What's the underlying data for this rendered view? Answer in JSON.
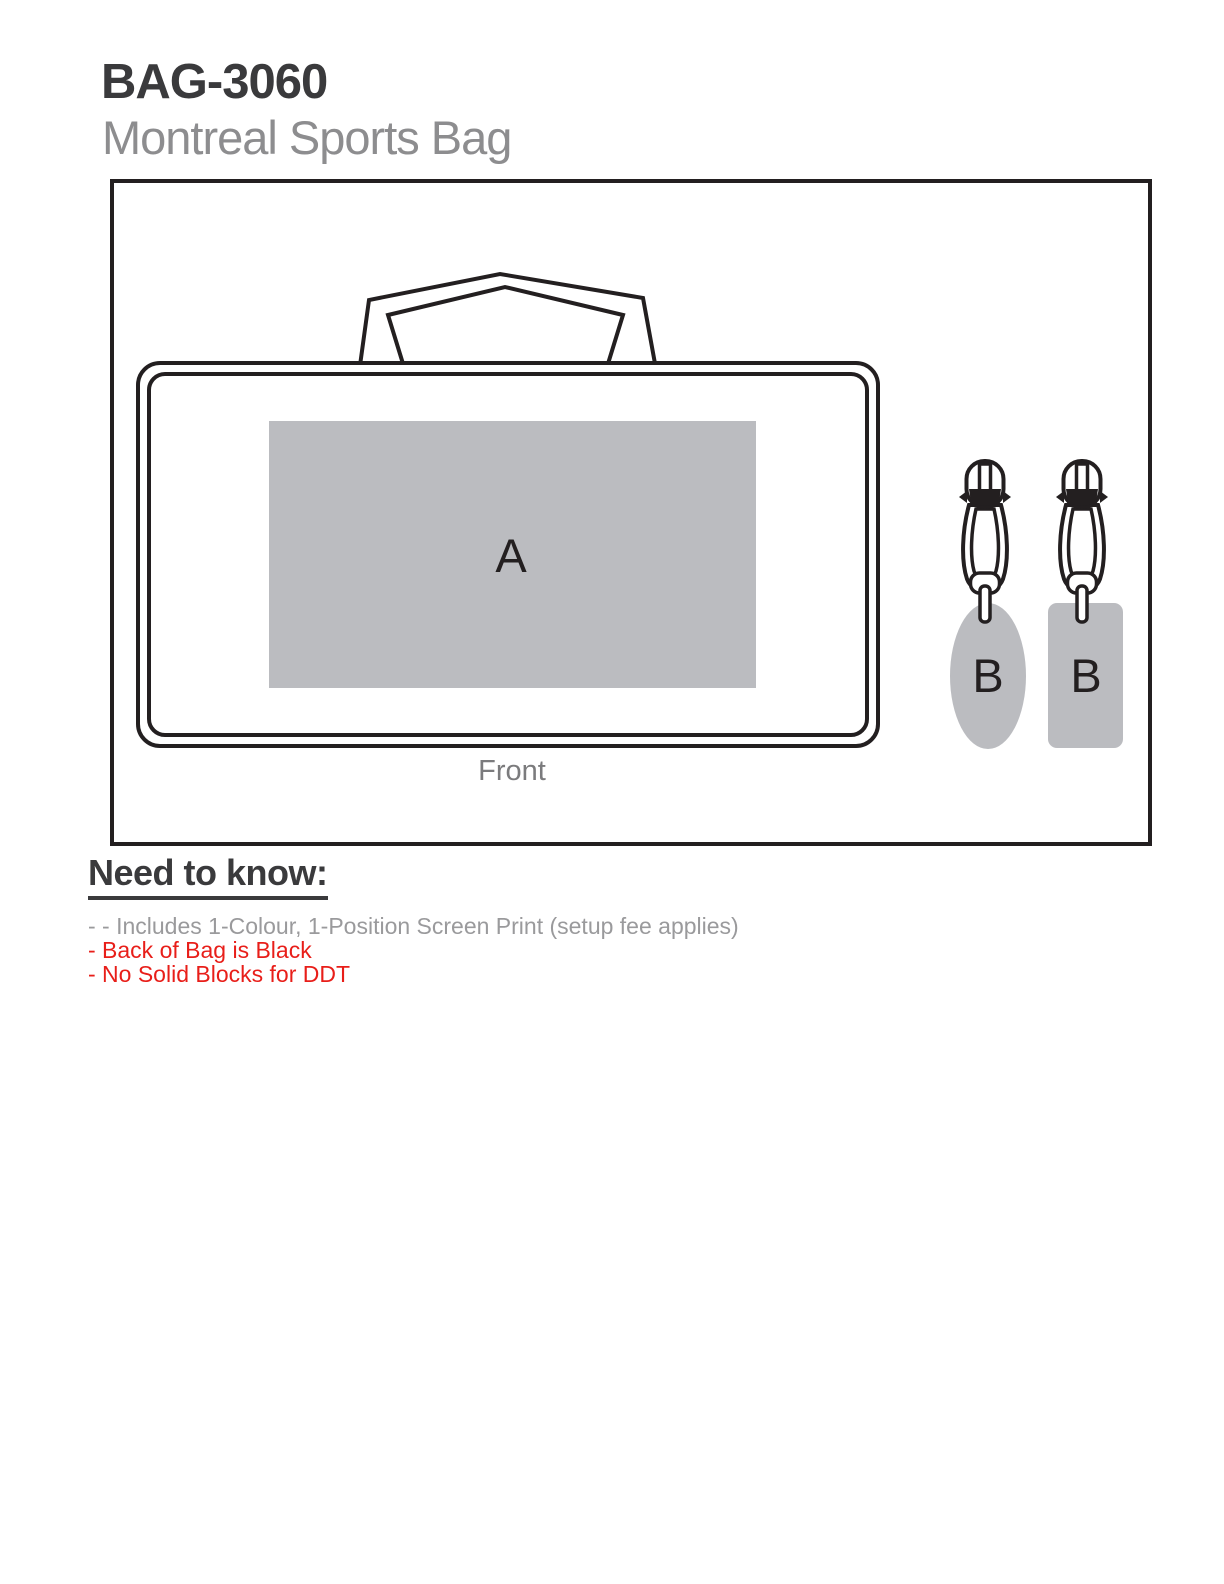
{
  "header": {
    "product_code": "BAG-3060",
    "product_name": "Montreal Sports Bag"
  },
  "diagram": {
    "view_label": "Front",
    "imprint_area_a": "A",
    "imprint_area_b_oval": "B",
    "imprint_area_b_rect": "B",
    "colors": {
      "outline": "#231f20",
      "imprint_fill": "#bbbcc0",
      "letter": "#231f20",
      "view_label": "#7b7b7d"
    }
  },
  "notes": {
    "heading": "Need to know:",
    "heading_color": "#3a3a3c",
    "items": [
      {
        "text": "- - Includes 1-Colour, 1-Position Screen Print (setup fee applies)",
        "color": "#9a9a9c"
      },
      {
        "text": "- Back of Bag is Black",
        "color": "#e81e19"
      },
      {
        "text": "- No Solid Blocks for DDT",
        "color": "#e81e19"
      }
    ]
  },
  "colors": {
    "title": "#3a3a3c",
    "subtitle": "#8d8d8f"
  }
}
